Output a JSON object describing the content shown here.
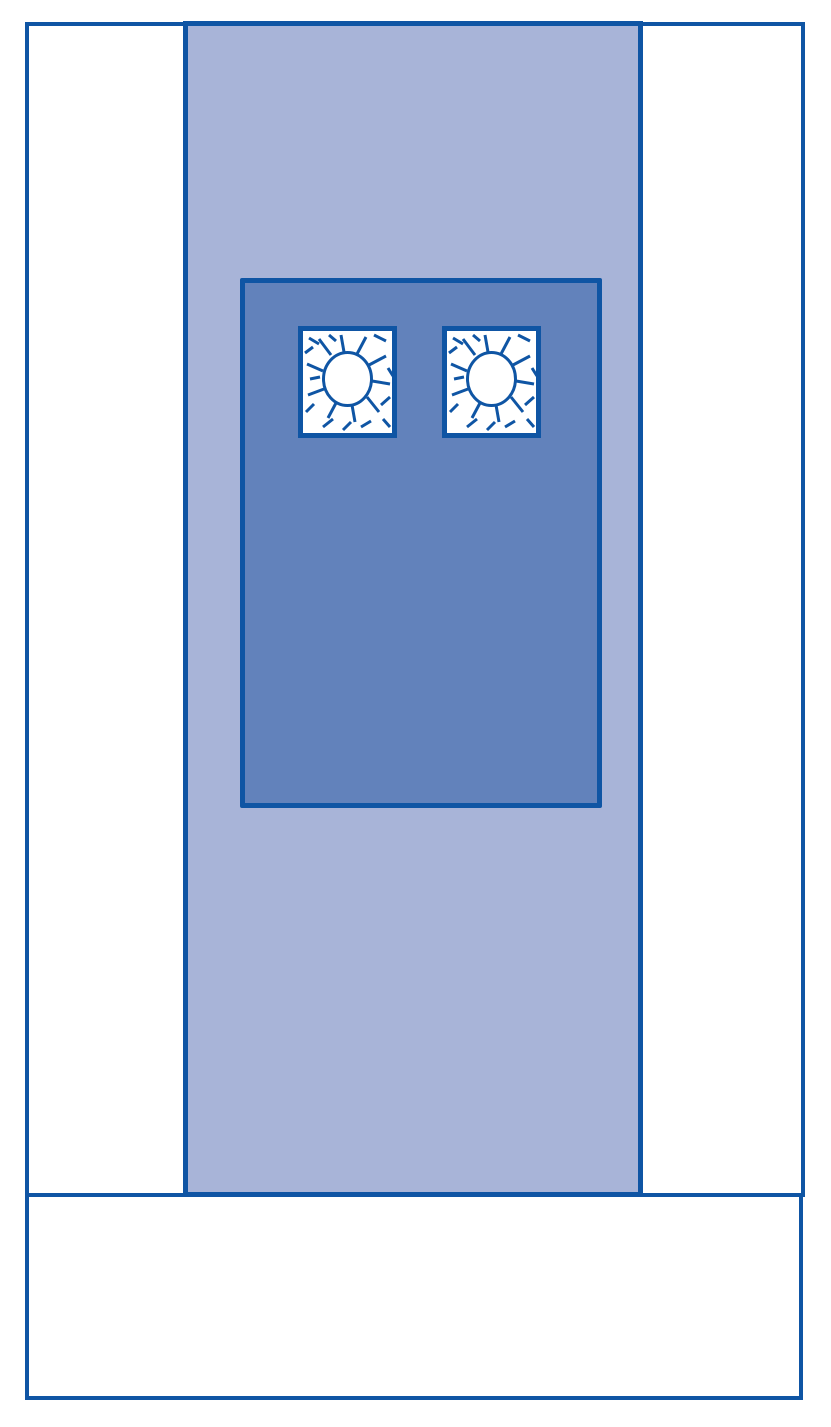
{
  "diagram": {
    "kind": "surgical-drape-schematic",
    "colors": {
      "outline": "#0f55a4",
      "band": "#a8b4d8",
      "field": "#6282bb",
      "drape_white": "#ffffff"
    },
    "fenestrations": {
      "count": 2
    }
  }
}
